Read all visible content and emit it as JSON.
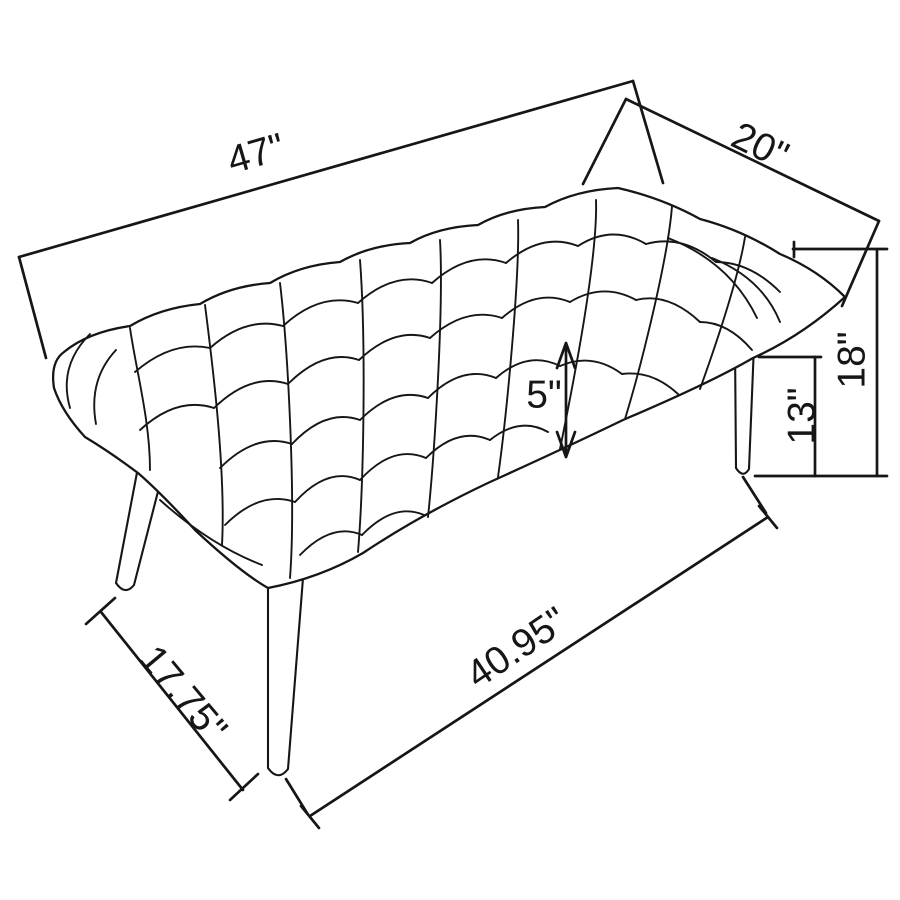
{
  "diagram": {
    "type": "furniture-dimension-drawing",
    "subject": "tufted-bench",
    "colors": {
      "ink": "#161616",
      "background": "#ffffff"
    },
    "dimensions": {
      "top_length": "47\"",
      "top_depth": "20\"",
      "overall_height": "18\"",
      "floor_to_frame": "13\"",
      "cushion_thickness": "5\"",
      "end_width": "17.75\"",
      "base_length": "40.95\""
    }
  }
}
